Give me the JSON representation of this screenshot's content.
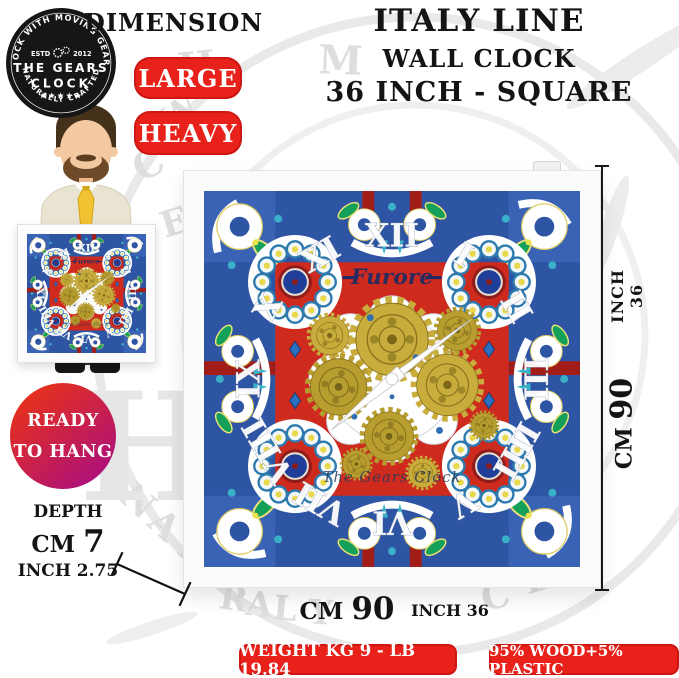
{
  "header": {
    "dimension": "DIMENSION",
    "title": "ITALY LINE",
    "subtitle": "WALL CLOCK",
    "size_line": "36 INCH - SQUARE"
  },
  "logo": {
    "arc_top": "CLOCK WITH MOVING GEARS",
    "estd": "ESTD",
    "year": "2012",
    "name1": "THE GEARS",
    "name2": "CLOCK",
    "stars": "★★★★★",
    "arc_bottom": "NATURALLY CRAFTED"
  },
  "badges": {
    "large": "LARGE",
    "heavy": "HEAVY",
    "weight": "WEIGHT KG 9 - LB 19.84",
    "material": "95% WOOD+5% PLASTIC"
  },
  "ready": {
    "line1": "READY",
    "line2": "TO HANG"
  },
  "depth": {
    "label": "DEPTH",
    "cm_unit": "CM",
    "cm_value": "7",
    "inch_line": "INCH 2.75"
  },
  "side": {
    "inch": "INCH 36",
    "cm_unit": "CM",
    "cm_value": "90"
  },
  "bottom": {
    "cm_unit": "CM",
    "cm_value": "90",
    "inch": "INCH 36"
  },
  "clock": {
    "brand": "Furore",
    "maker": "The Gears Clock",
    "numerals": [
      "XII",
      "I",
      "II",
      "III",
      "IIII",
      "V",
      "VI",
      "VII",
      "VIII",
      "IX",
      "X",
      "XI"
    ]
  },
  "watermark": {
    "letters": [
      "T",
      "H",
      "M",
      "W",
      "C",
      "E",
      "N",
      "A",
      "T",
      "R",
      "A",
      "L",
      "Y",
      "C",
      "B",
      "E",
      "H"
    ]
  },
  "colors": {
    "badge_red": "#e8211a",
    "ready_start": "#e4301d",
    "ready_end": "#b01277",
    "face_red": "#cf2a1e",
    "face_blue": "#2e54a4",
    "gear_gold": "#c9ad3c",
    "leaf_green": "#14a058",
    "frame_white": "#fbfbfb"
  }
}
